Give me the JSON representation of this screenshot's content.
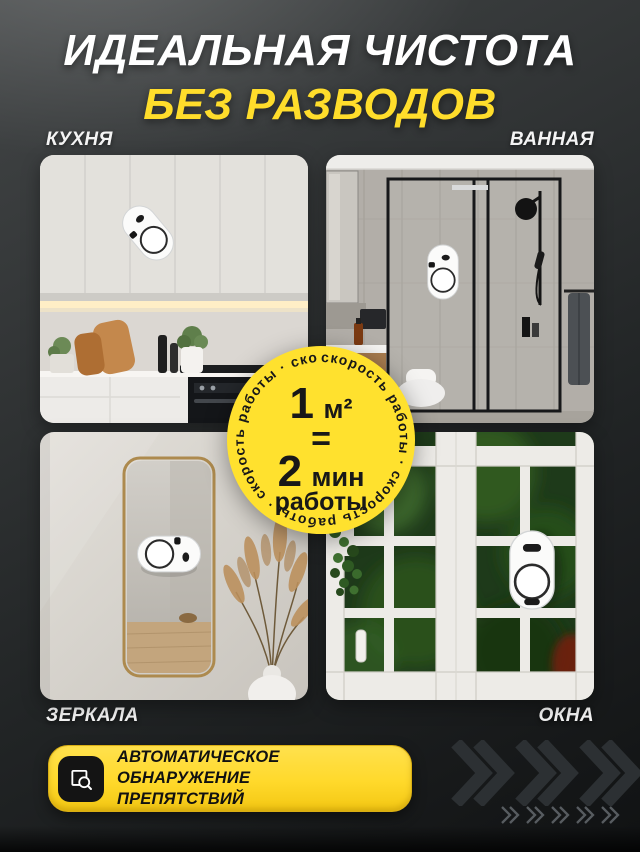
{
  "header": {
    "title": "ИДЕАЛЬНАЯ ЧИСТОТА",
    "subtitle": "БЕЗ РАЗВОДОВ"
  },
  "scenes": {
    "kitchen": {
      "label": "КУХНЯ"
    },
    "bathroom": {
      "label": "ВАННАЯ"
    },
    "mirrors": {
      "label": "ЗЕРКАЛА"
    },
    "windows": {
      "label": "ОКНА"
    }
  },
  "badge": {
    "ring_text": "скорость работы  ·  скорость работы  ·  скорость работы  ·  скорость работы  · ",
    "area_value": "1",
    "area_unit": "м²",
    "equals_sign": "=",
    "time_value": "2",
    "time_unit": "мин",
    "time_caption": "работы"
  },
  "banner": {
    "line1": "АВТОМАТИЧЕСКОЕ ОБНАРУЖЕНИЕ",
    "line2": "ПРЕПЯТСТВИЙ"
  },
  "icons": {
    "banner_icon": "obstacle-detection-scan-icon",
    "decor_icons": "chevron-right-icon"
  },
  "colors": {
    "accent_yellow": "#FFDD2B",
    "badge_yellow": "#FFE12E",
    "background_dark": "#232627",
    "title_white": "#FFFFFF",
    "text_black": "#121212"
  },
  "decor": {
    "large_chevrons": 3,
    "small_chevrons": 5
  }
}
